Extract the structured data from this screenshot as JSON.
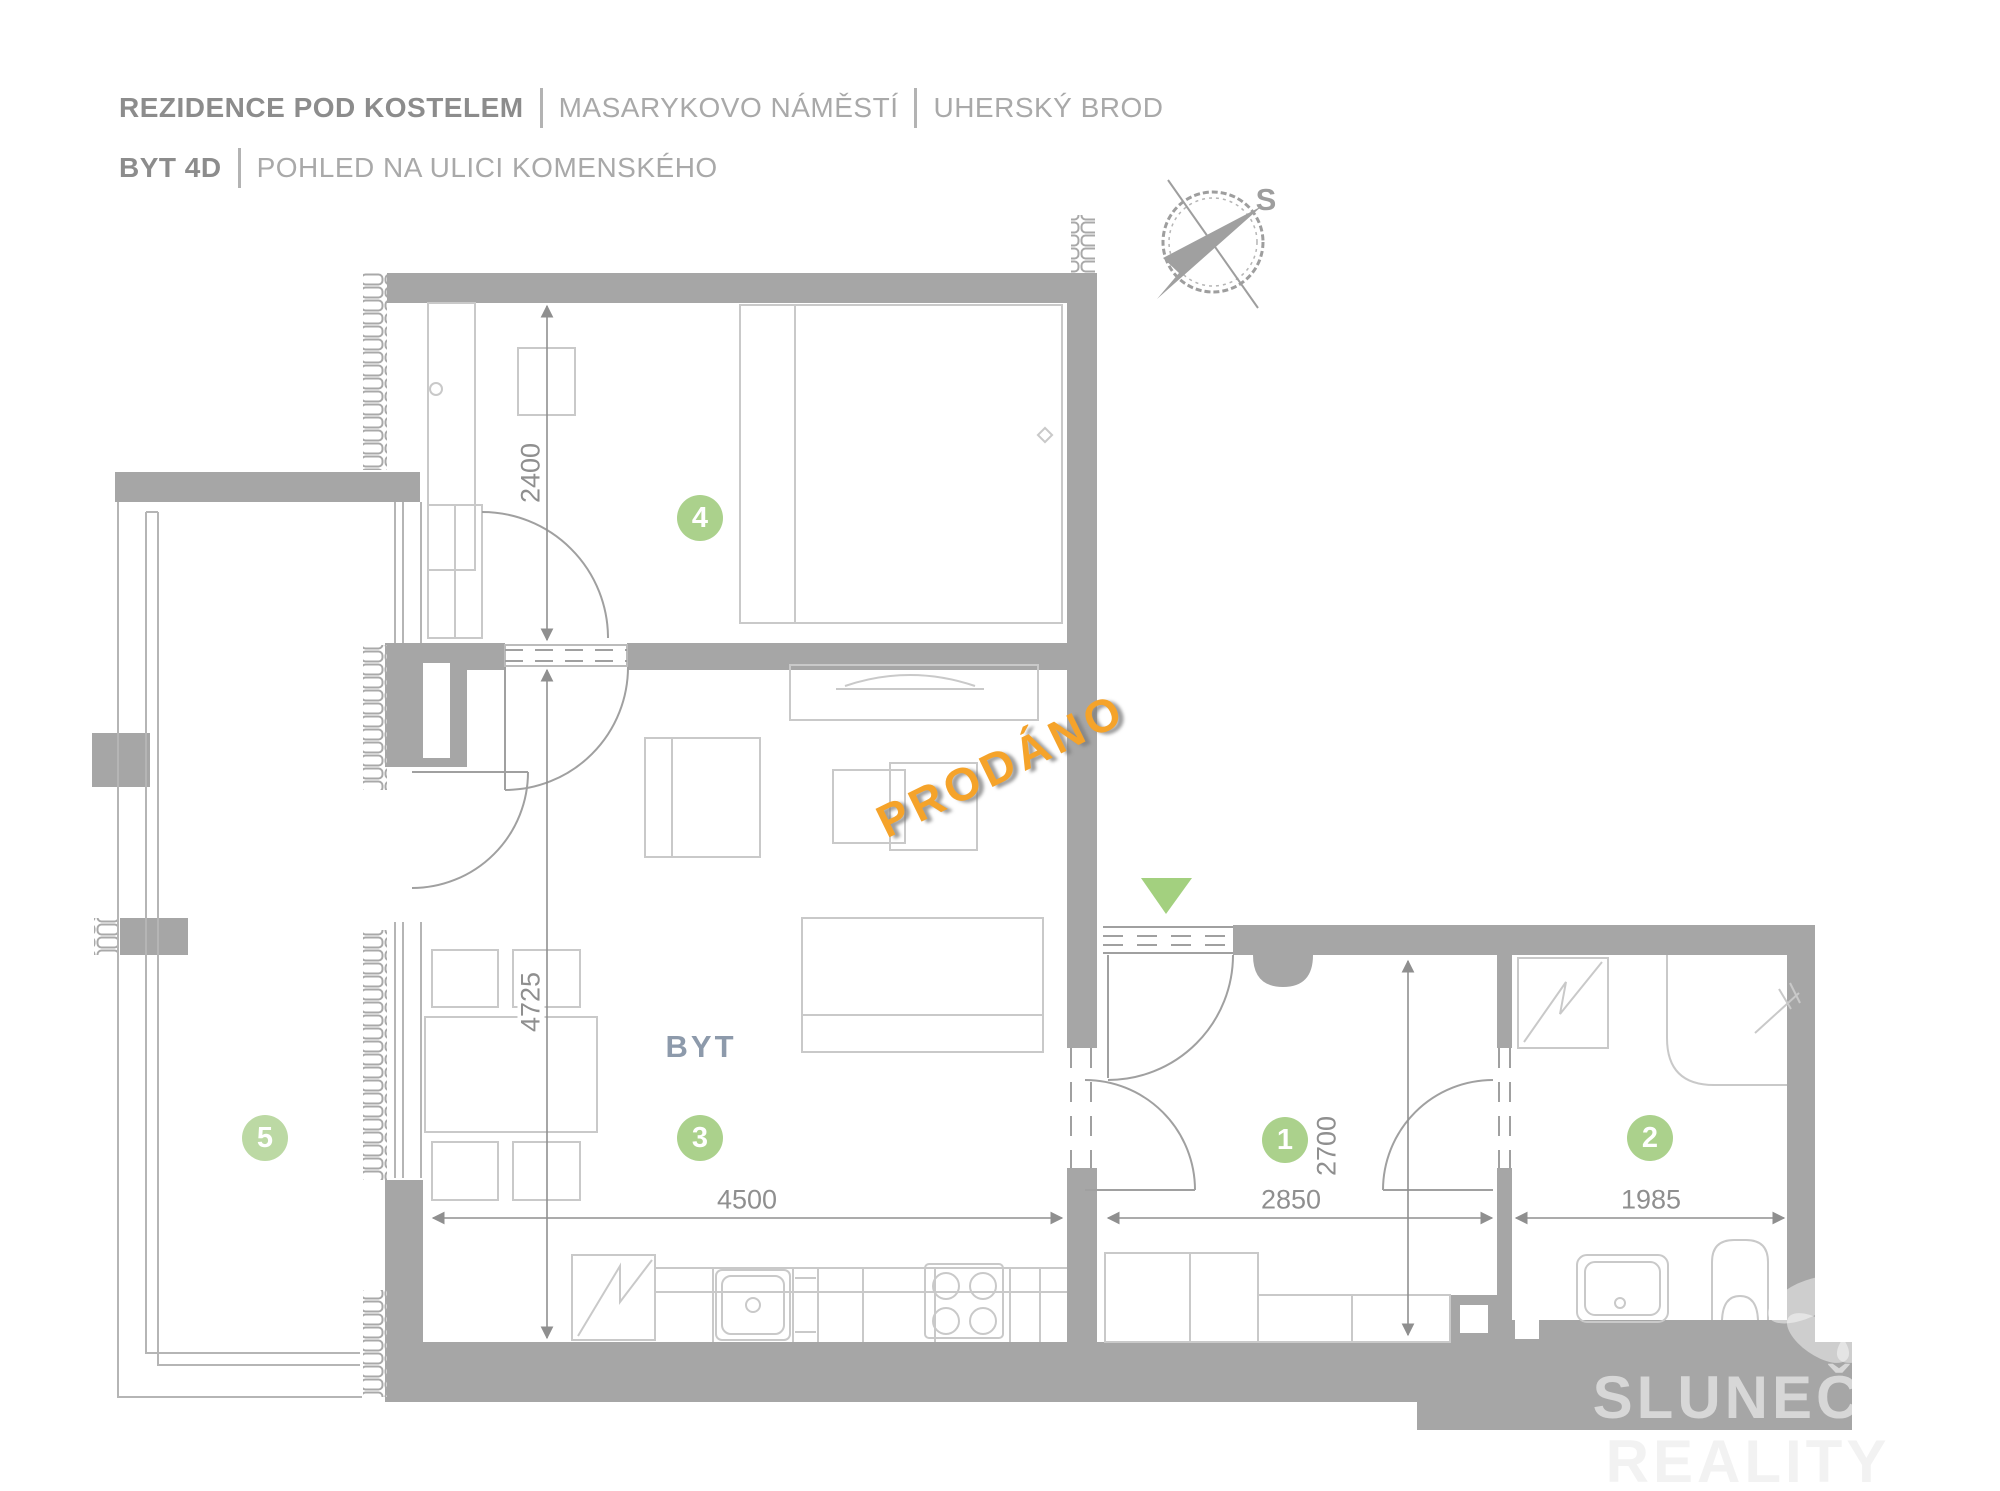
{
  "header": {
    "project": "REZIDENCE POD KOSTELEM",
    "location": "MASARYKOVO NÁMĚSTÍ",
    "city": "UHERSKÝ BROD",
    "unit": "BYT 4D",
    "view_title": "POHLED NA ULICI KOMENSKÉHO"
  },
  "compass": {
    "north_label": "S"
  },
  "status": {
    "label": "PRODÁNO",
    "color": "#f5a32a"
  },
  "plan": {
    "apartment_label": "BYT",
    "room_badges": [
      {
        "number": "1"
      },
      {
        "number": "2"
      },
      {
        "number": "3"
      },
      {
        "number": "4"
      },
      {
        "number": "5"
      }
    ],
    "dimensions_mm": [
      {
        "value": "2400",
        "orientation": "vertical"
      },
      {
        "value": "4725",
        "orientation": "vertical"
      },
      {
        "value": "4500",
        "orientation": "horizontal"
      },
      {
        "value": "2850",
        "orientation": "horizontal"
      },
      {
        "value": "1985",
        "orientation": "horizontal"
      },
      {
        "value": "2700",
        "orientation": "vertical"
      }
    ]
  },
  "watermark": {
    "line1": "SLUNEČNÍ",
    "line2": "REALITY"
  },
  "colors": {
    "wall_gray": "#a6a6a6",
    "badge_green": "#abd18c",
    "entrance_green": "#a3d07f",
    "accent_orange": "#f5a32a",
    "dim_text": "#8f8f8f"
  }
}
